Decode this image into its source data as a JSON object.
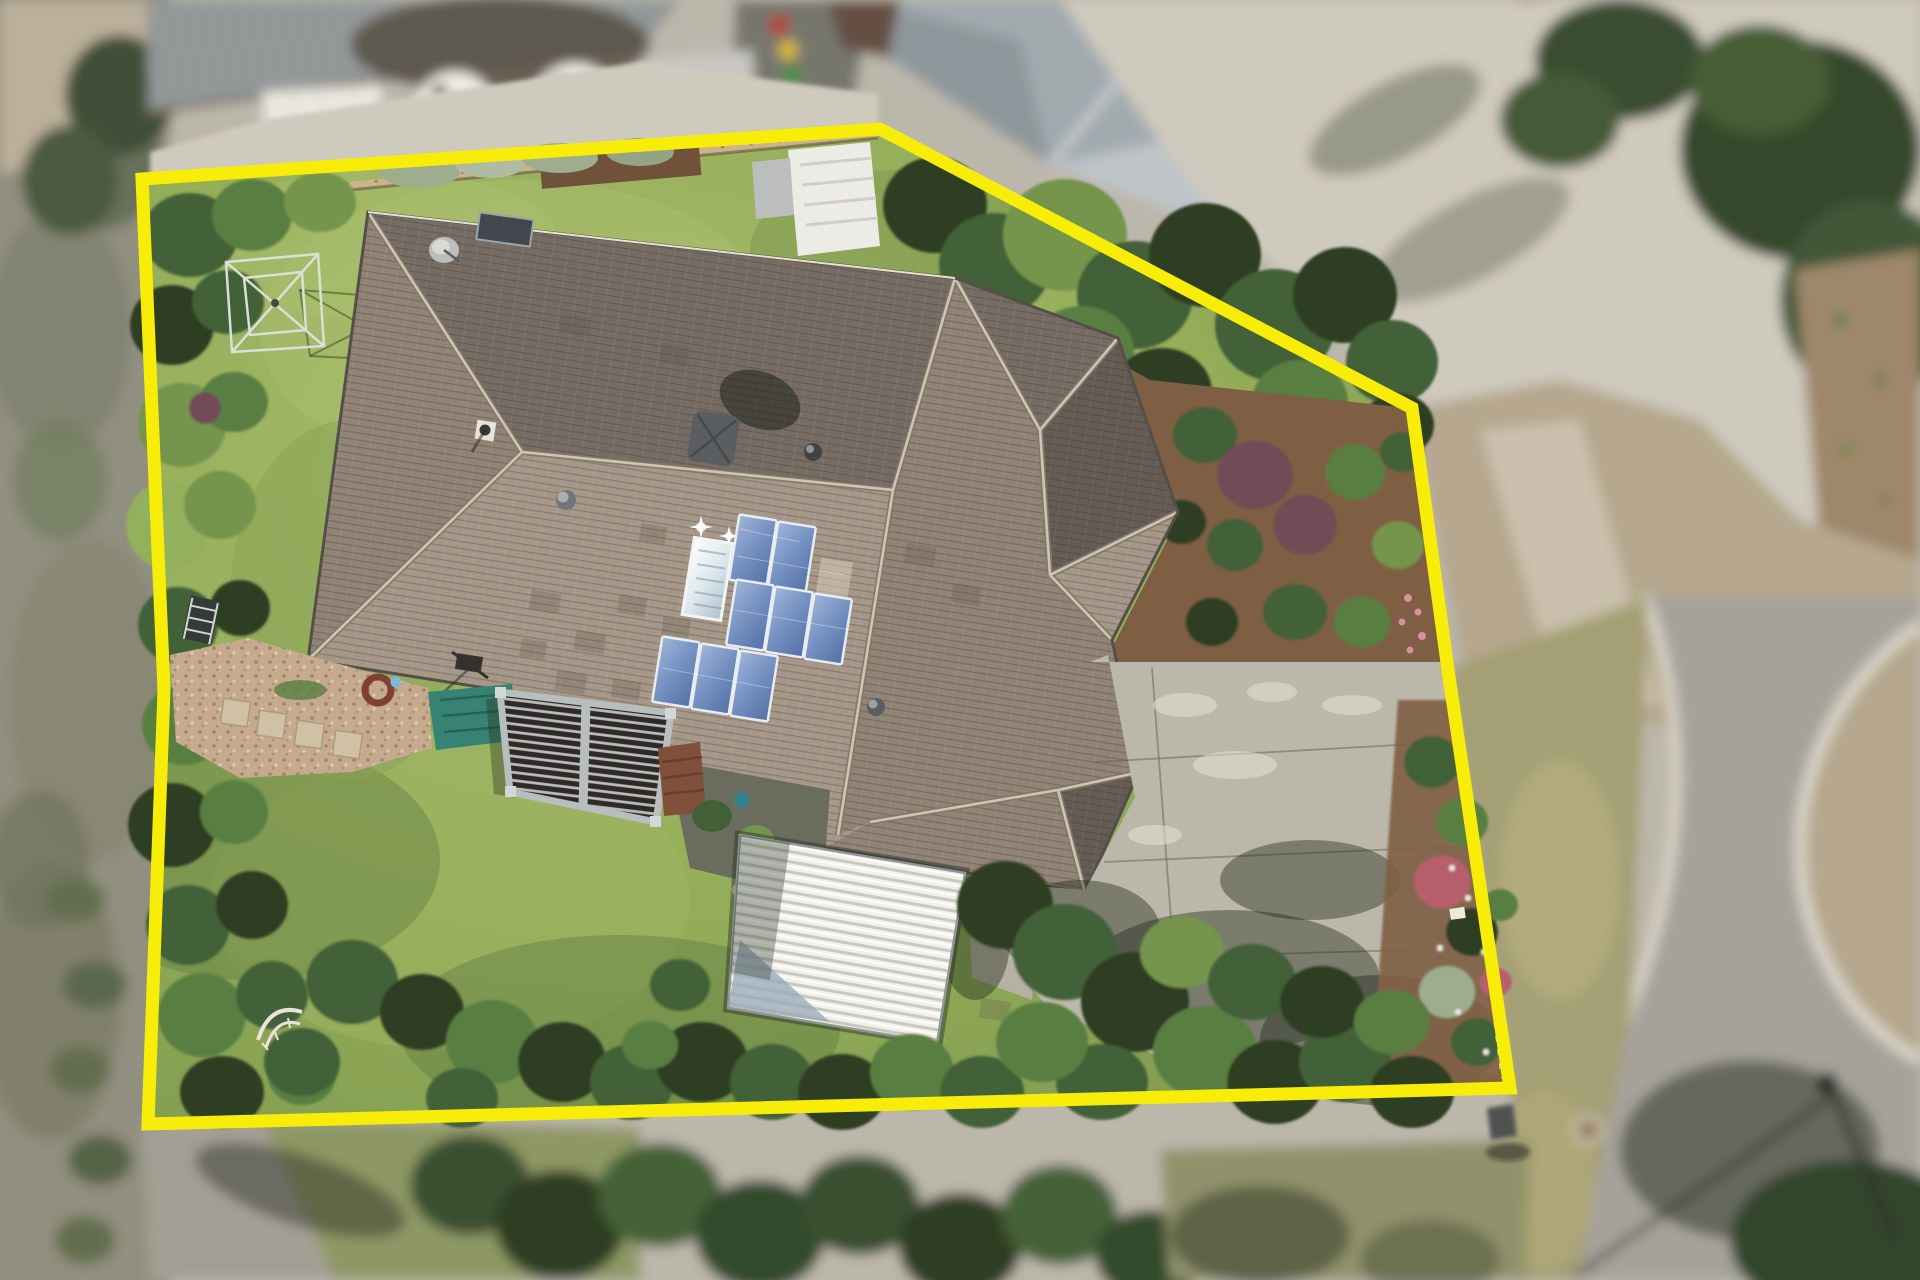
{
  "scene": {
    "type": "aerial-drone-photograph",
    "description": "Top-down real-estate drone photo of a suburban house on a large block, property boundary highlighted with a thick yellow outline; surroundings are depth-of-field blurred",
    "property": {
      "house": "large hip-roof home with brown concrete tiles",
      "solar_pv_panel_count": 8,
      "solar_hot_water_panels": 1,
      "structures": [
        "louvre pergola",
        "white corrugated garden shed",
        "concrete driveway",
        "rotary clothesline",
        "garden arch"
      ],
      "gardens": [
        "lawn",
        "dense shrub borders",
        "mulched garden beds",
        "pebble bed with stepping stones",
        "teal tarp"
      ]
    },
    "surroundings": {
      "neighbor_water_tank_count": 3,
      "wheelie_bin_colors": [
        "red",
        "yellow",
        "green"
      ],
      "road": "cul-de-sac with concrete kerb",
      "street_light_count": 1
    }
  },
  "boundary": {
    "points": "142,179 880,129 1412,408 1448,670 1510,1088 148,1124 164,690",
    "stroke_width": "13"
  },
  "colors": {
    "boundaryYellow": "#f7ee00",
    "lawn": "#8fab55",
    "lawnLight": "#a8be6a",
    "lawnShadow": "#58763a",
    "roofLight": "#a39586",
    "roofMid": "#8d8073",
    "roofDark": "#716860",
    "roofDarkest": "#5f5750",
    "roofRidge": "#cfc4b0",
    "gutter": "#4e4a44",
    "pergolaSlat": "#282320",
    "pergolaFrame": "#b6bcbe",
    "shedWhite": "#f1f1ec",
    "shedRib": "#c8c8c0",
    "shedShade": "#92a6b5",
    "concrete": "#bab6aa",
    "concreteLight": "#cdc9bd",
    "mulch": "#7a5a3e",
    "pebble": "#c3a88c",
    "tarp": "#2f7f70",
    "deck": "#7c4a36",
    "asphalt": "#a3a099",
    "kerb": "#d8d4c8",
    "verge": "#a29d72",
    "dirt": "#b3a58c",
    "scrub": "#8d8c7c",
    "metalRoof": "#8f9596",
    "neighborRoof": "#9fa8ad",
    "neighborRoofLight": "#bcc3c7",
    "tank": "#eceadf",
    "fence": "#c9b289",
    "panelBlue": "#7391c4",
    "panelBlueDark": "#4d6ba3",
    "solarHW": "#dde9f0",
    "green1": "#26391f",
    "green2": "#3b5c31",
    "green3": "#527a3c",
    "green4": "#6f9247",
    "green5": "#8fae58",
    "silverGreen": "#9aab8c",
    "purpleBush": "#6d4452",
    "pinkFlower": "#c97f92",
    "binRed": "#b8312f",
    "binYellow": "#d8b82e",
    "binGreen": "#3f8f3c"
  }
}
